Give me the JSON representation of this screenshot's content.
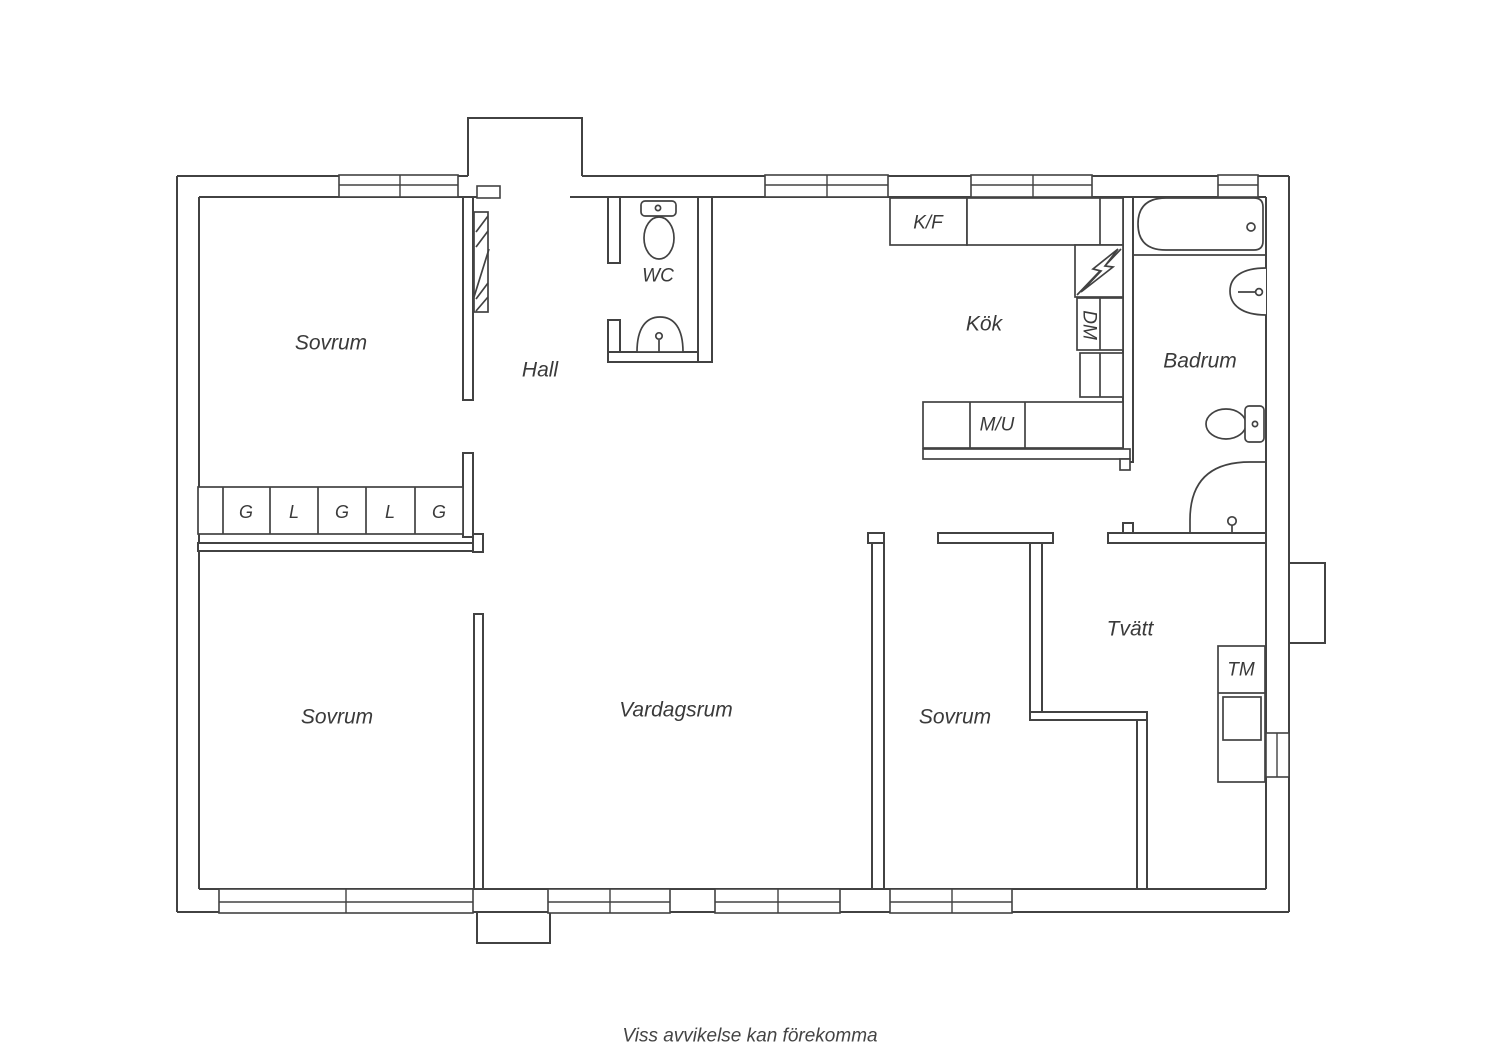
{
  "floorplan": {
    "rooms": {
      "sovrum1": "Sovrum",
      "sovrum2": "Sovrum",
      "sovrum3": "Sovrum",
      "hall": "Hall",
      "wc": "WC",
      "kok": "Kök",
      "badrum": "Badrum",
      "vardagsrum": "Vardagsrum",
      "tvatt": "Tvätt"
    },
    "appliances": {
      "fridge_freezer": "K/F",
      "micro_oven": "M/U",
      "dishwasher": "DM",
      "washing_machine": "TM"
    },
    "closets": [
      "G",
      "L",
      "G",
      "L",
      "G"
    ],
    "footer": "Viss avvikelse kan förekomma",
    "colors": {
      "line": "#424242",
      "text": "#3a3a3a",
      "background": "#ffffff"
    }
  }
}
